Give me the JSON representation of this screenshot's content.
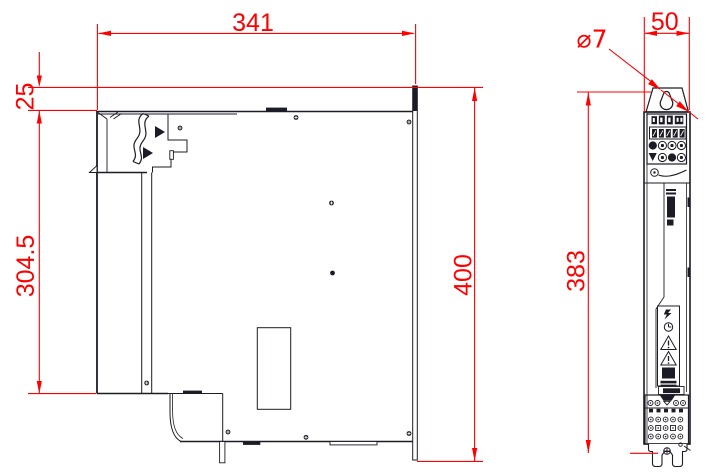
{
  "drawing": {
    "side_view": {
      "dim_width_mm": "341",
      "dim_plate_offset_mm": "25",
      "dim_front_height_mm": "304.5",
      "dim_total_height_mm": "400"
    },
    "front_view": {
      "dim_width_mm": "50",
      "dim_hole_diameter": "⌀7",
      "dim_mount_height_mm": "383"
    },
    "colors": {
      "dimension_red": "#fe0000",
      "line_black": "#1c1c26",
      "background": "#ffffff"
    }
  }
}
